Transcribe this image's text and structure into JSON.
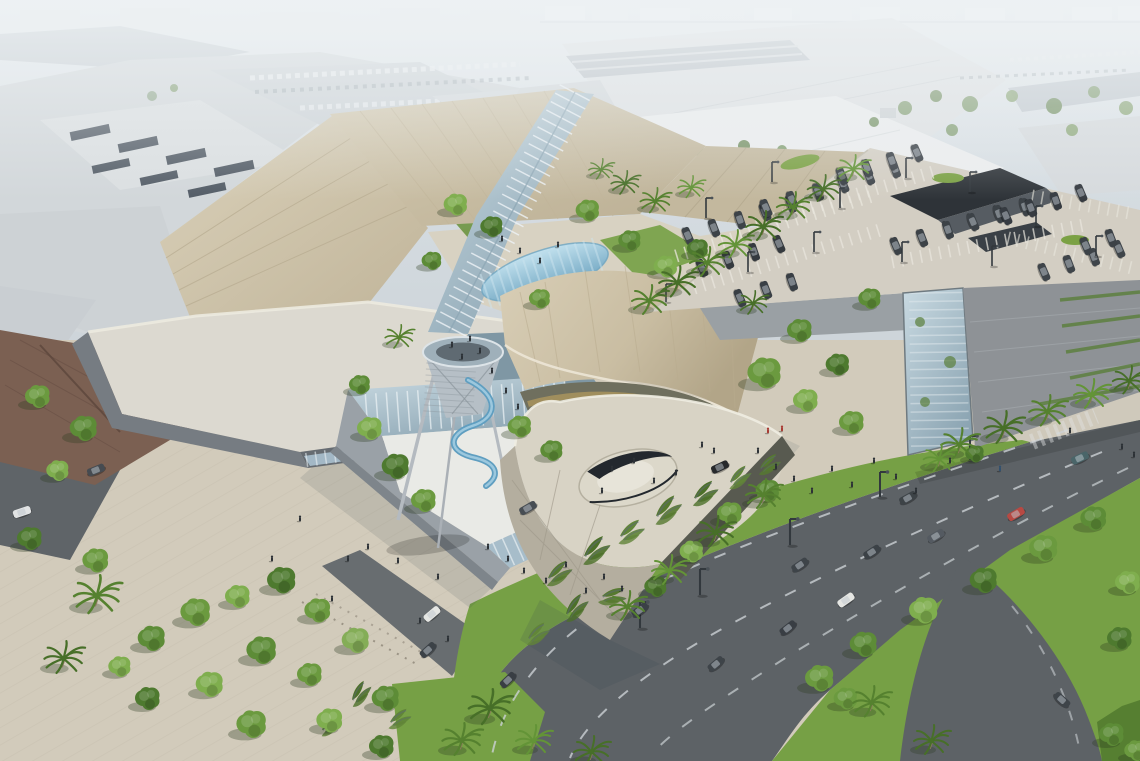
{
  "meta": {
    "scene": "Aerial architectural rendering of a shopping mall expansion: angular champagne metal roofs with a glass skylight spine, glass entry atrium, funnel-shaped observation tower with blue spiral slide, curved-roof pavilion with terrace, rooftop parking deck with garage, palm-lined landscaped boulevard, hazy city horizon",
    "time_of_day": "daytime, hazy"
  },
  "palette": {
    "haze": "#d8dee3",
    "cityFar": "#c9d1d7",
    "cityMid": "#d2d7da",
    "whiteRoof": "#e2e5e7",
    "tanRoof": "#cdc2a8",
    "tanRoofLight": "#d8cfb8",
    "tanRoofDark": "#bdb296",
    "paleRoof": "#dcd9d0",
    "glass": "#a7bdca",
    "glassLight": "#c6d7df",
    "vaultBlue": "#7fb3cc",
    "shingle": "#7b6052",
    "plaza": "#d2cbbb",
    "road": "#5d6266",
    "grass": "#76a045",
    "grassDark": "#567f31",
    "deck": "#d3cec3",
    "garageWall": "#8e9296",
    "fascia": "#767c82",
    "carDark": "#2f353b",
    "amber": "#c2a45e",
    "treeGreen": "#6b9a3f"
  },
  "scene": {
    "trees": [
      [
        38,
        398,
        1,
        "#6b9a3f"
      ],
      [
        84,
        430,
        1.1,
        "#5d8c37"
      ],
      [
        58,
        472,
        0.9,
        "#7fae4e"
      ],
      [
        30,
        540,
        1,
        "#4e7a2f"
      ],
      [
        96,
        562,
        1.05,
        "#6b9a3f"
      ],
      [
        152,
        640,
        1.1,
        "#5d8c37"
      ],
      [
        196,
        614,
        1.2,
        "#6b9a3f"
      ],
      [
        238,
        598,
        1,
        "#7fae4e"
      ],
      [
        282,
        582,
        1.15,
        "#4e7a2f"
      ],
      [
        318,
        612,
        1.05,
        "#6b9a3f"
      ],
      [
        262,
        652,
        1.2,
        "#5d8c37"
      ],
      [
        210,
        686,
        1.1,
        "#7fae4e"
      ],
      [
        310,
        676,
        1,
        "#6b9a3f"
      ],
      [
        356,
        642,
        1.1,
        "#84ad57"
      ],
      [
        386,
        700,
        1.1,
        "#5d8c37"
      ],
      [
        252,
        726,
        1.2,
        "#6b9a3f"
      ],
      [
        148,
        700,
        1,
        "#4e7a2f"
      ],
      [
        120,
        668,
        0.9,
        "#7fae4e"
      ],
      [
        330,
        722,
        1.05,
        "#7fae4e"
      ],
      [
        382,
        748,
        1,
        "#4e7a2f"
      ],
      [
        370,
        430,
        1,
        "#7fae4e"
      ],
      [
        396,
        468,
        1.1,
        "#4e7a2f"
      ],
      [
        424,
        502,
        1,
        "#6b9a3f"
      ],
      [
        360,
        386,
        0.85,
        "#5d8c37"
      ],
      [
        520,
        428,
        0.95,
        "#6b9a3f"
      ],
      [
        552,
        452,
        0.9,
        "#5d8c37"
      ],
      [
        456,
        206,
        0.95,
        "#7fae4e"
      ],
      [
        492,
        228,
        0.9,
        "#4e7a2f"
      ],
      [
        588,
        212,
        0.95,
        "#6b9a3f"
      ],
      [
        630,
        242,
        0.9,
        "#5d8c37"
      ],
      [
        666,
        268,
        0.95,
        "#7fae4e"
      ],
      [
        698,
        250,
        0.85,
        "#4e7a2f"
      ],
      [
        432,
        262,
        0.8,
        "#5d8c37"
      ],
      [
        540,
        300,
        0.85,
        "#6b9a3f"
      ],
      [
        765,
        375,
        1.35,
        "#6b9a3f"
      ],
      [
        800,
        332,
        1,
        "#5d8c37"
      ],
      [
        806,
        402,
        1,
        "#7fae4e"
      ],
      [
        838,
        366,
        0.95,
        "#4e7a2f"
      ],
      [
        852,
        424,
        1,
        "#6b9a3f"
      ],
      [
        870,
        300,
        0.9,
        "#5d8c37"
      ],
      [
        730,
        515,
        1,
        "#6b9a3f"
      ],
      [
        768,
        492,
        0.95,
        "#5d8c37"
      ],
      [
        692,
        553,
        0.95,
        "#7fae4e"
      ],
      [
        656,
        588,
        0.9,
        "#4e7a2f"
      ],
      [
        820,
        680,
        1.15,
        "#6b9a3f"
      ],
      [
        864,
        646,
        1.1,
        "#5d8c37"
      ],
      [
        924,
        612,
        1.15,
        "#7fae4e"
      ],
      [
        984,
        582,
        1.1,
        "#4e7a2f"
      ],
      [
        1044,
        550,
        1.15,
        "#6b9a3f"
      ],
      [
        1094,
        520,
        1.05,
        "#5d8c37"
      ],
      [
        1128,
        584,
        1,
        "#7fae4e"
      ],
      [
        846,
        700,
        0.95,
        "#6b9a3f"
      ],
      [
        1120,
        640,
        1,
        "#4e7a2f"
      ],
      [
        1112,
        736,
        1,
        "#5d8c37"
      ],
      [
        1136,
        752,
        0.9,
        "#6b9a3f"
      ],
      [
        975,
        455,
        0.75,
        "#4e7a2f"
      ]
    ],
    "palms": [
      [
        648,
        304,
        1,
        "#55812f"
      ],
      [
        676,
        286,
        1.05,
        "#476f28"
      ],
      [
        706,
        266,
        1,
        "#55812f"
      ],
      [
        734,
        248,
        0.95,
        "#639437"
      ],
      [
        762,
        230,
        1,
        "#476f28"
      ],
      [
        792,
        210,
        0.95,
        "#55812f"
      ],
      [
        822,
        192,
        0.9,
        "#476f28"
      ],
      [
        852,
        172,
        0.9,
        "#639437"
      ],
      [
        958,
        448,
        1.05,
        "#55812f"
      ],
      [
        1002,
        432,
        1.1,
        "#476f28"
      ],
      [
        1046,
        415,
        1.05,
        "#55812f"
      ],
      [
        1090,
        398,
        1,
        "#639437"
      ],
      [
        1128,
        384,
        0.95,
        "#476f28"
      ],
      [
        938,
        462,
        0.9,
        "#639437"
      ],
      [
        762,
        498,
        1,
        "#55812f"
      ],
      [
        714,
        536,
        1.05,
        "#476f28"
      ],
      [
        668,
        574,
        1,
        "#639437"
      ],
      [
        626,
        610,
        1,
        "#55812f"
      ],
      [
        488,
        712,
        1.2,
        "#476f28"
      ],
      [
        460,
        744,
        1.1,
        "#55812f"
      ],
      [
        532,
        744,
        1,
        "#639437"
      ],
      [
        870,
        706,
        1.05,
        "#55812f"
      ],
      [
        930,
        744,
        1,
        "#476f28"
      ],
      [
        95,
        600,
        1.3,
        "#55812f"
      ],
      [
        62,
        662,
        1.1,
        "#476f28"
      ],
      [
        624,
        186,
        0.8,
        "#476f28"
      ],
      [
        654,
        204,
        0.85,
        "#55812f"
      ],
      [
        690,
        190,
        0.75,
        "#639437"
      ],
      [
        600,
        172,
        0.7,
        "#55812f"
      ],
      [
        752,
        306,
        0.8,
        "#476f28"
      ],
      [
        398,
        340,
        0.8,
        "#55812f"
      ],
      [
        590,
        755,
        1,
        "#476f28"
      ]
    ],
    "hedges": [
      [
        548,
        578,
        1,
        -15
      ],
      [
        584,
        556,
        1.1,
        -18
      ],
      [
        620,
        536,
        1,
        -12
      ],
      [
        656,
        516,
        1.1,
        -20
      ],
      [
        694,
        498,
        1,
        -15
      ],
      [
        730,
        482,
        0.9,
        -18
      ],
      [
        602,
        596,
        0.95,
        10
      ],
      [
        566,
        614,
        1,
        -25
      ],
      [
        528,
        638,
        0.9,
        -15
      ],
      [
        760,
        468,
        0.85,
        -12
      ],
      [
        352,
        700,
        0.9,
        -30
      ],
      [
        390,
        722,
        0.85,
        -10
      ],
      [
        322,
        730,
        0.8,
        -20
      ]
    ],
    "cars": [
      [
        1080,
        458,
        -25,
        "#3d5a5e"
      ],
      [
        1016,
        514,
        -30,
        "#b23c35"
      ],
      [
        936,
        536,
        -31,
        "#474e55"
      ],
      [
        872,
        552,
        -33,
        "#2e343a"
      ],
      [
        846,
        600,
        -35,
        "#e4e5e1"
      ],
      [
        908,
        498,
        -29,
        "#2f353a"
      ],
      [
        788,
        628,
        -38,
        "#2b3036"
      ],
      [
        716,
        664,
        -40,
        "#30363c"
      ],
      [
        800,
        565,
        -34,
        "#30363c"
      ],
      [
        640,
        610,
        -37,
        "#2c3238"
      ],
      [
        428,
        650,
        -42,
        "#2e343a"
      ],
      [
        508,
        680,
        -44,
        "#2b3036"
      ],
      [
        432,
        614,
        -40,
        "#e4e5e1"
      ],
      [
        1062,
        700,
        42,
        "#30363c"
      ],
      [
        720,
        467,
        -25,
        "#17191c"
      ],
      [
        528,
        508,
        -30,
        "#3a4046"
      ],
      [
        22,
        512,
        -18,
        "#dfe1e2"
      ],
      [
        96,
        470,
        -22,
        "#383e44"
      ]
    ],
    "deck_rows": [
      [
        688,
        236,
        -17,
        5,
        27,
        "#2f353b"
      ],
      [
        702,
        268,
        -17,
        4,
        27,
        "#262c31"
      ],
      [
        766,
        208,
        -17,
        6,
        27,
        "#31373d"
      ],
      [
        842,
        176,
        -17,
        4,
        26,
        "#2b3137"
      ],
      [
        896,
        246,
        -17,
        6,
        27,
        "#2e343a"
      ],
      [
        1006,
        216,
        -17,
        4,
        26,
        "#272d33"
      ],
      [
        1044,
        272,
        -17,
        4,
        26,
        "#31373d"
      ],
      [
        740,
        298,
        -17,
        3,
        27,
        "#2b3137"
      ],
      [
        1086,
        246,
        -17,
        2,
        26,
        "#2e343a"
      ]
    ],
    "poles": [
      [
        706,
        218,
        1
      ],
      [
        772,
        182,
        1
      ],
      [
        840,
        208,
        1
      ],
      [
        906,
        178,
        1
      ],
      [
        970,
        192,
        1
      ],
      [
        1036,
        226,
        1
      ],
      [
        902,
        262,
        1
      ],
      [
        814,
        252,
        1
      ],
      [
        748,
        272,
        1
      ],
      [
        1096,
        256,
        1
      ],
      [
        992,
        266,
        1
      ],
      [
        666,
        302,
        0.9
      ],
      [
        700,
        595,
        1.3
      ],
      [
        790,
        545,
        1.3
      ],
      [
        880,
        497,
        1.25
      ],
      [
        970,
        460,
        1.2
      ],
      [
        640,
        628,
        1.3
      ]
    ],
    "people": [
      [
        480,
        352
      ],
      [
        492,
        372
      ],
      [
        506,
        392
      ],
      [
        518,
        408
      ],
      [
        470,
        340
      ],
      [
        452,
        346
      ],
      [
        462,
        358
      ],
      [
        508,
        560
      ],
      [
        524,
        572
      ],
      [
        546,
        582
      ],
      [
        566,
        566
      ],
      [
        586,
        592
      ],
      [
        604,
        578
      ],
      [
        622,
        590
      ],
      [
        488,
        548
      ],
      [
        438,
        578
      ],
      [
        398,
        562
      ],
      [
        368,
        548
      ],
      [
        348,
        560
      ],
      [
        300,
        520
      ],
      [
        272,
        560
      ],
      [
        332,
        600
      ],
      [
        420,
        622
      ],
      [
        448,
        640
      ],
      [
        758,
        452
      ],
      [
        776,
        468
      ],
      [
        794,
        480
      ],
      [
        812,
        492
      ],
      [
        832,
        470
      ],
      [
        852,
        486
      ],
      [
        874,
        462
      ],
      [
        896,
        478
      ],
      [
        916,
        492
      ],
      [
        768,
        432,
        "#a83b33"
      ],
      [
        782,
        430,
        "#a83b33"
      ],
      [
        1000,
        470,
        "#31506e"
      ],
      [
        612,
        470
      ],
      [
        634,
        462
      ],
      [
        654,
        482
      ],
      [
        676,
        474
      ],
      [
        602,
        492
      ],
      [
        520,
        252
      ],
      [
        540,
        262
      ],
      [
        558,
        246
      ],
      [
        502,
        240
      ],
      [
        950,
        462
      ],
      [
        1070,
        432
      ],
      [
        702,
        446
      ],
      [
        714,
        452
      ],
      [
        1122,
        448
      ],
      [
        1134,
        456
      ]
    ],
    "bg_dots": [
      [
        905,
        108,
        7,
        "#7d9a6b"
      ],
      [
        936,
        96,
        6,
        "#6d8b5a"
      ],
      [
        970,
        104,
        8,
        "#7d9a6b"
      ],
      [
        1012,
        96,
        6,
        "#87a371"
      ],
      [
        1054,
        106,
        8,
        "#6d8b5a"
      ],
      [
        1094,
        92,
        6,
        "#7d9a6b"
      ],
      [
        1126,
        108,
        7,
        "#87a371"
      ],
      [
        874,
        122,
        5,
        "#6d8b5a"
      ],
      [
        952,
        130,
        6,
        "#7d9a6b"
      ],
      [
        1072,
        130,
        6,
        "#87a371"
      ],
      [
        700,
        152,
        5,
        "#7d9a6b"
      ],
      [
        744,
        146,
        6,
        "#6d8b5a"
      ],
      [
        782,
        150,
        5,
        "#7d9a6b"
      ],
      [
        152,
        96,
        5,
        "#8aa285"
      ],
      [
        174,
        88,
        4,
        "#7d9a6b"
      ],
      [
        618,
        154,
        5,
        "#7d9a6b"
      ],
      [
        660,
        156,
        5,
        "#6d8b5a"
      ]
    ],
    "road_paint": [
      {
        "d": "M1068,430 C920,480 760,535 640,590 C560,628 505,690 492,755",
        "w": 2,
        "dash": "12 16",
        "c": "#ccd1d4",
        "o": 0.8
      },
      {
        "d": "M1102,452 C960,510 820,575 720,630 C640,675 585,720 570,758",
        "w": 2,
        "dash": "12 16",
        "c": "#ccd1d4",
        "o": 0.8
      },
      {
        "d": "M1128,468 C1000,530 880,600 790,655 C720,700 672,730 650,756",
        "w": 2,
        "dash": "12 16",
        "c": "#ccd1d4",
        "o": 0.7
      },
      {
        "d": "M1012,606 C1046,648 1070,700 1080,752",
        "w": 2,
        "dash": "10 14",
        "c": "#c8cdd0",
        "o": 0.6
      },
      {
        "x1": 705,
        "y1": 452,
        "x2": 768,
        "y2": 468,
        "w": 14,
        "dash": "3.5 5",
        "c": "#e8e5da",
        "o": 0.65
      },
      {
        "x1": 1032,
        "y1": 442,
        "x2": 1096,
        "y2": 416,
        "w": 16,
        "dash": "3.5 5",
        "c": "#dfe3e2",
        "o": 0.45
      },
      {
        "x1": 302,
        "y1": 602,
        "x2": 420,
        "y2": 666,
        "w": 2,
        "dash": "2 7",
        "c": "#8d8678",
        "o": 0.8
      },
      {
        "x1": 316,
        "y1": 594,
        "x2": 432,
        "y2": 658,
        "w": 2,
        "dash": "2 7",
        "c": "#8d8678",
        "o": 0.6
      },
      {
        "x1": 480,
        "y1": 340,
        "x2": 596,
        "y2": 548,
        "w": 44,
        "dash": "1.5 11",
        "c": "#cdc6b4",
        "o": 0.45
      }
    ],
    "deck_paint": [
      {
        "x1": 676,
        "y1": 256,
        "x2": 872,
        "y2": 196,
        "w": 13,
        "dash": "1.6 8",
        "c": "#eae7de",
        "o": 0.75
      },
      {
        "x1": 694,
        "y1": 288,
        "x2": 880,
        "y2": 230,
        "w": 13,
        "dash": "1.6 8",
        "c": "#eae7de",
        "o": 0.7
      },
      {
        "x1": 756,
        "y1": 224,
        "x2": 940,
        "y2": 170,
        "w": 13,
        "dash": "1.6 8",
        "c": "#eae7de",
        "o": 0.7
      },
      {
        "x1": 892,
        "y1": 262,
        "x2": 1090,
        "y2": 224,
        "w": 13,
        "dash": "1.6 8",
        "c": "#eae7de",
        "o": 0.7
      },
      {
        "x1": 1008,
        "y1": 238,
        "x2": 1132,
        "y2": 268,
        "w": 13,
        "dash": "1.6 8",
        "c": "#eae7de",
        "o": 0.6
      },
      {
        "x1": 1032,
        "y1": 196,
        "x2": 1136,
        "y2": 214,
        "w": 13,
        "dash": "1.6 8",
        "c": "#eae7de",
        "o": 0.6
      },
      {
        "x1": 652,
        "y1": 310,
        "x2": 868,
        "y2": 150,
        "w": 1.5,
        "c": "#bcb6a8",
        "o": 0.8
      }
    ]
  }
}
